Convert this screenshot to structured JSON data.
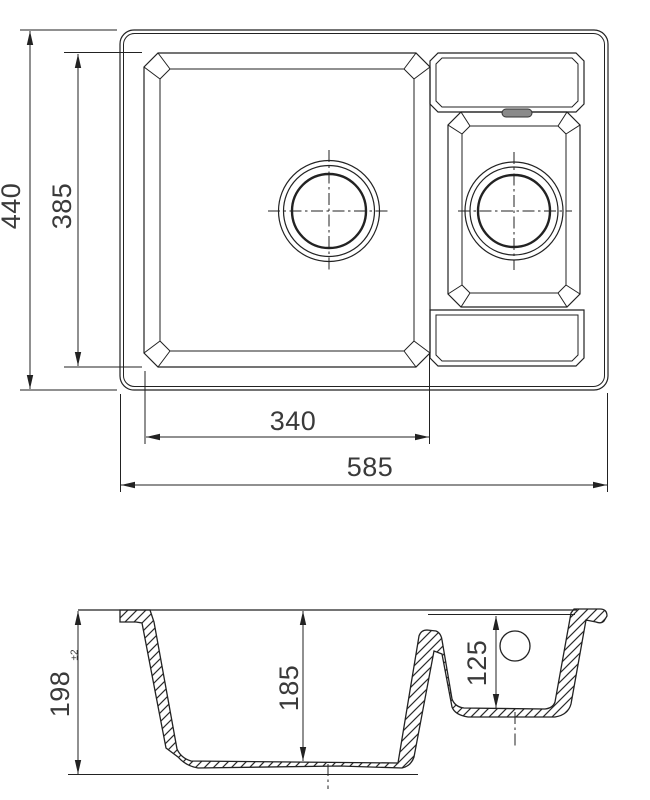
{
  "drawing": {
    "view_top": {
      "dim_overall_width": "585",
      "dim_bowl_width": "340",
      "dim_overall_depth": "440",
      "dim_inner_depth": "385"
    },
    "view_section": {
      "dim_overall_height": "198",
      "dim_overall_height_tolerance": "±2",
      "dim_main_bowl_depth": "185",
      "dim_small_bowl_depth": "125"
    },
    "colors": {
      "line": "#222222",
      "text": "#3a3a3a",
      "background": "#ffffff"
    }
  }
}
